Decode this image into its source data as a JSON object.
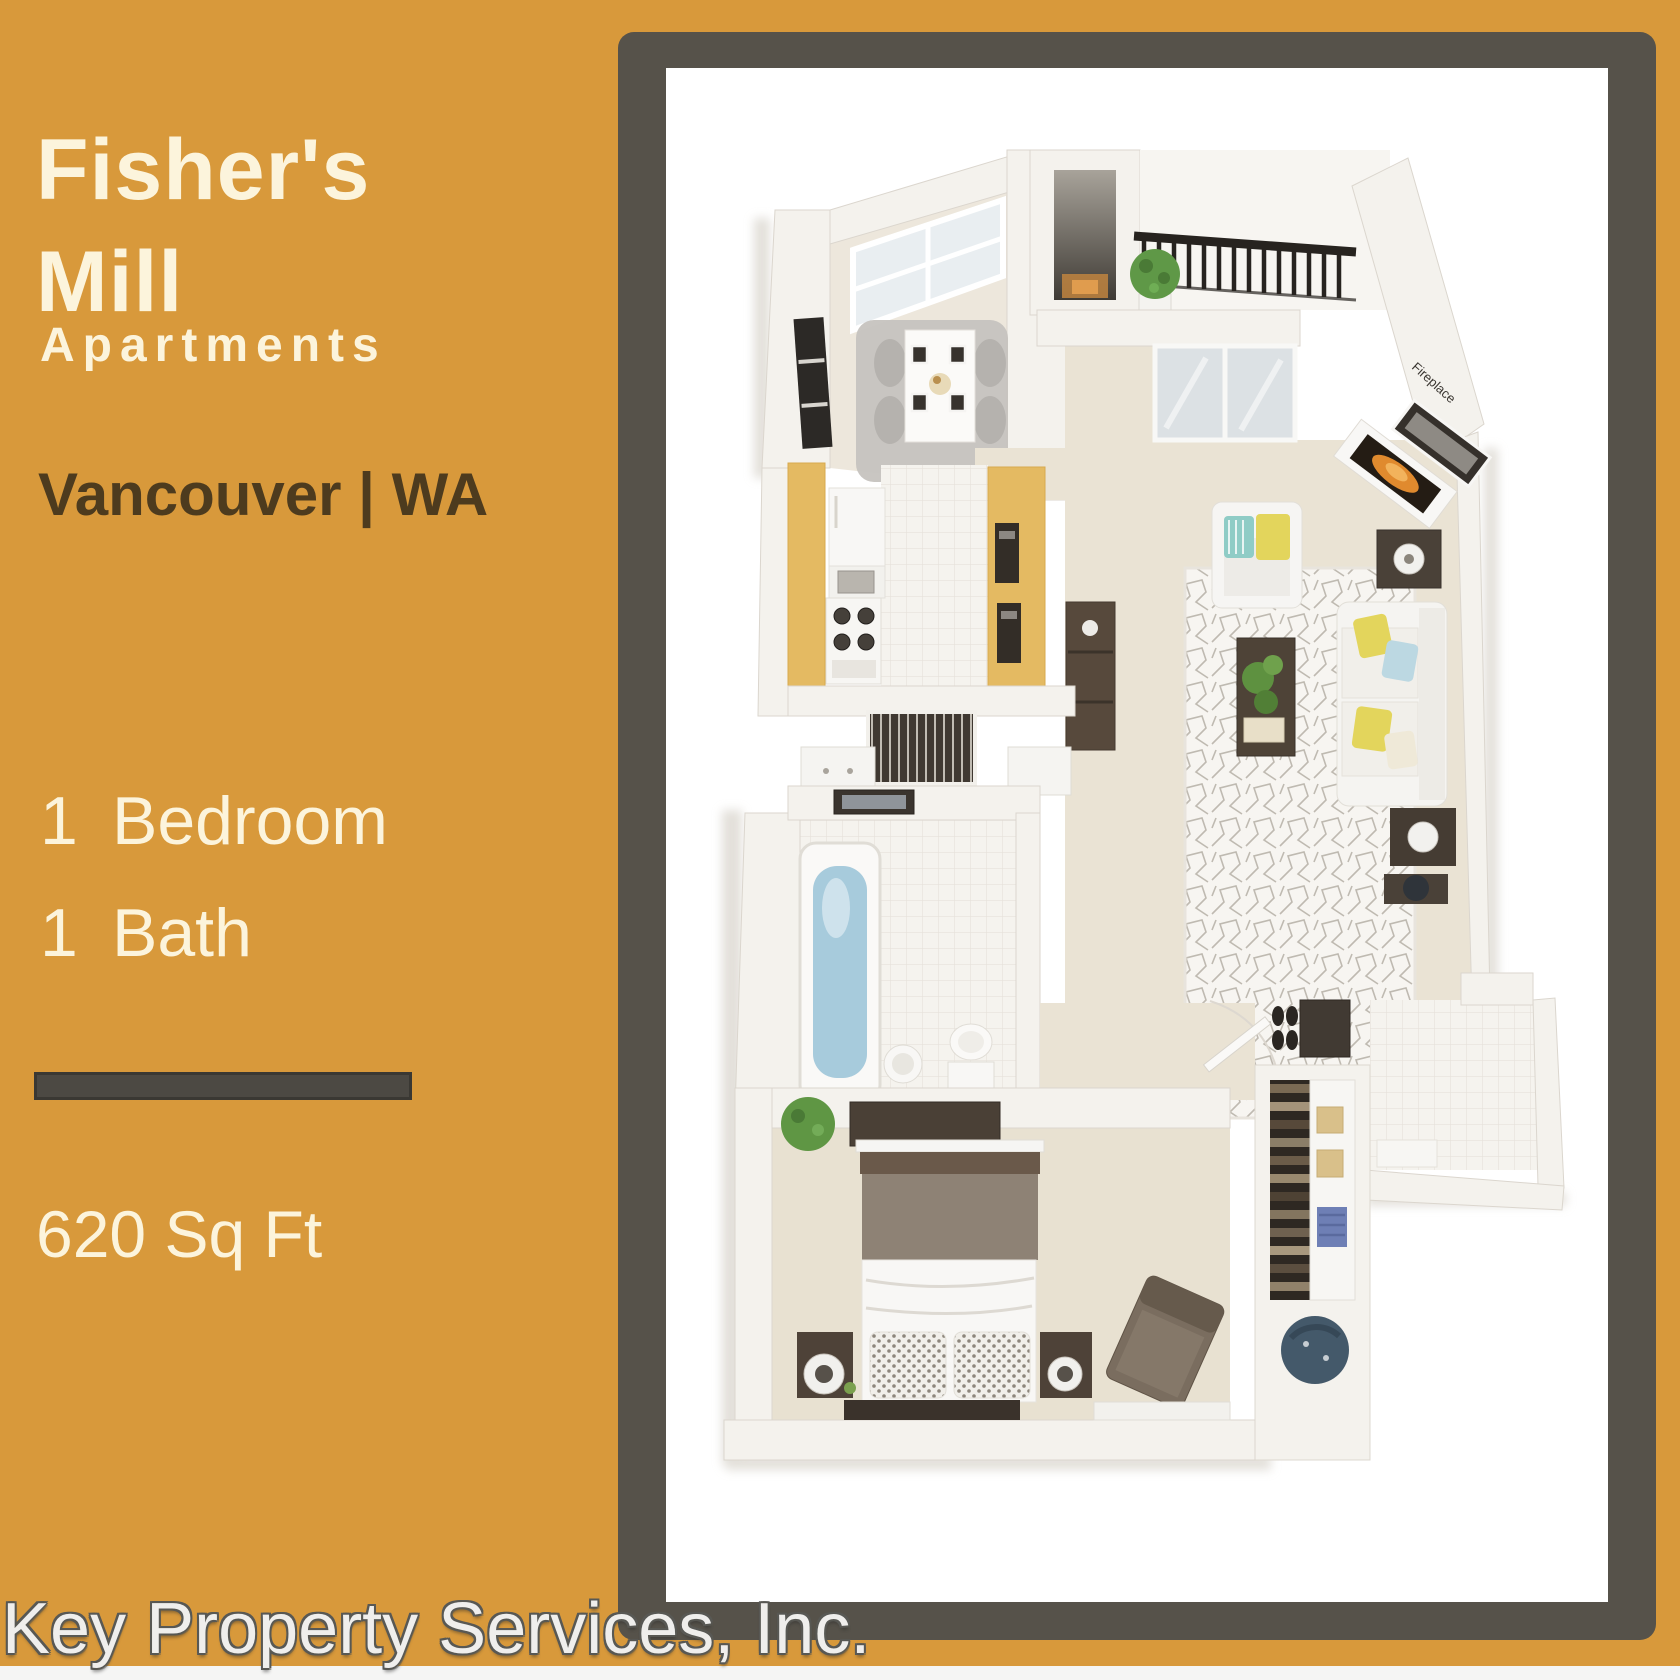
{
  "poster": {
    "background_color": "#D8993B",
    "frame_color": "#56524A",
    "panel_color": "#FFFFFF",
    "title_text_color": "#FCF4DC",
    "location_text_color": "#4D3B1E",
    "title": {
      "line1": "Fisher's",
      "line2": "Mill"
    },
    "subtitle": "Apartments",
    "location": "Vancouver | WA",
    "features": [
      {
        "value": "1",
        "label": "Bedroom"
      },
      {
        "value": "1",
        "label": "Bath"
      }
    ],
    "area": "620 Sq Ft",
    "footer": "Key Property Services, Inc."
  },
  "floorplan": {
    "description": "3D top-down rendering of a one-bedroom, one-bath apartment",
    "fireplace_label": "Fireplace",
    "colors": {
      "cabinets": "#E4BA62",
      "tub_water": "#A7CBDC",
      "sofa": "#F5F4F1",
      "pillow_yellow": "#E3D55C",
      "pillow_blue": "#BCD8E2",
      "pillow_teal": "#8FCCC6",
      "dark_wood": "#4E4238",
      "fire": "#E08A2E",
      "plant_green": "#5F9847",
      "carpet": "#EAE3D4",
      "wall": "#F4F2ED",
      "bed_blanket": "#8E8275",
      "railing_black": "#27231F",
      "beanbag_blue": "#44596A"
    }
  }
}
